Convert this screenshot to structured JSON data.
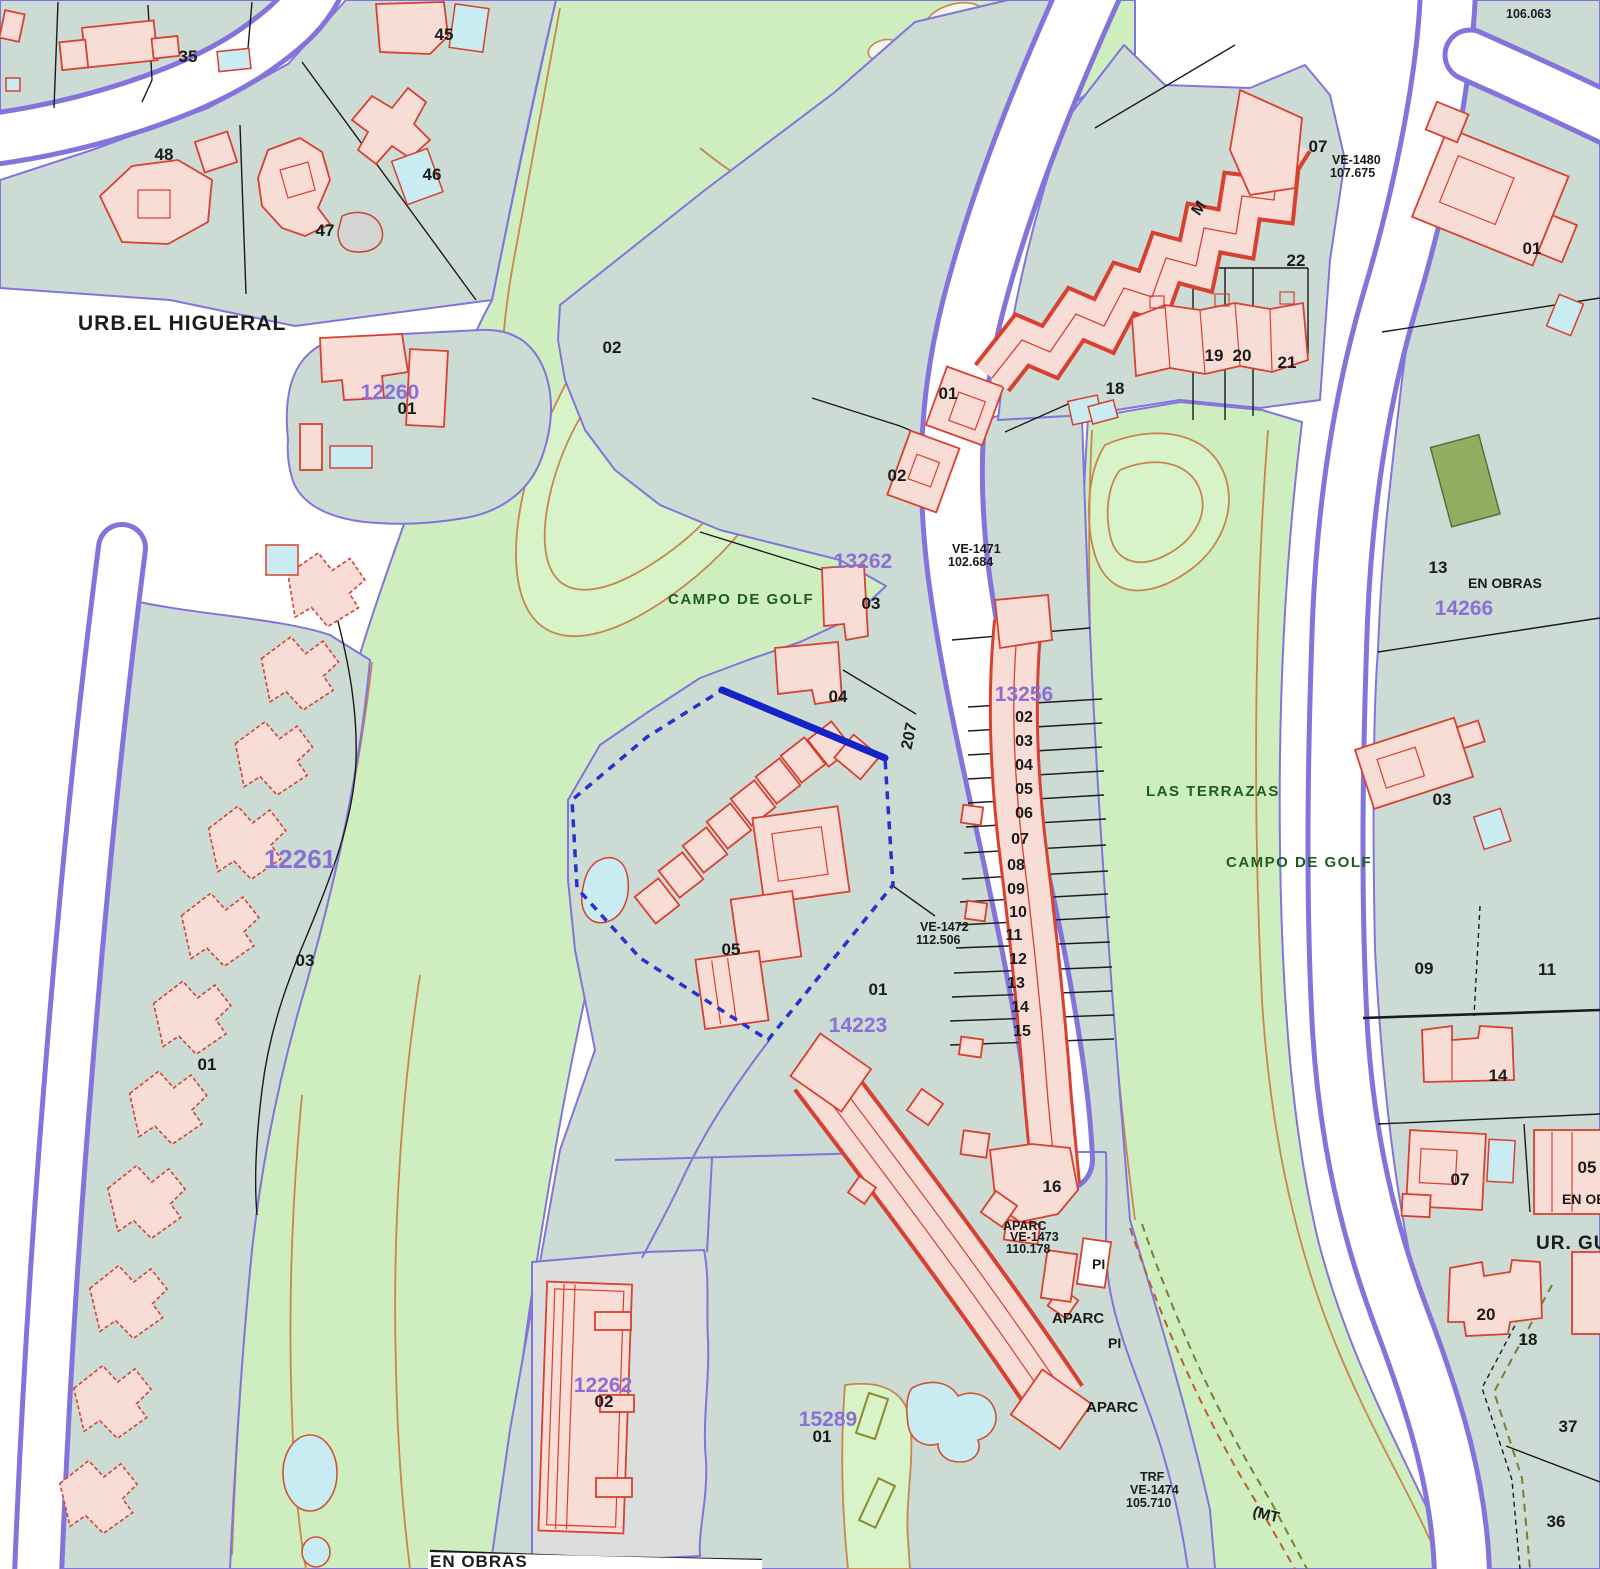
{
  "map_type": "cadastral-parcel-map",
  "colors": {
    "parcel_fill": "#ccdbd3",
    "golf_fill": "#cfeec0",
    "road_fill": "#ffffff",
    "boundary_purple": "#8374dc",
    "building_fill": "#f8ddd7",
    "building_stroke": "#d8402f",
    "pool_fill": "#c9ecf2",
    "selected_blue": "#2433cc",
    "contour_orange": "#c8854e",
    "parcel_id_purple": "#8b6fd4",
    "golf_text_green": "#1e5c20"
  },
  "labels": {
    "urb": "URB.EL HIGUERAL",
    "campo1": "CAMPO DE GOLF",
    "campo2": "CAMPO DE GOLF",
    "lasterrazas": "LAS TERRAZAS",
    "enobras1": "EN OBRAS",
    "enobras2": "EN OBRAS",
    "enobras3": "EN OBRAS",
    "urgu": "UR. GU",
    "p12260": "12260",
    "p12261": "12261",
    "p12262": "12262",
    "p13256": "13256",
    "p13262": "13262",
    "p14223": "14223",
    "p14266": "14266",
    "p15289": "15289",
    "n35": "35",
    "n45": "45",
    "n48": "48",
    "n46": "46",
    "n47": "47",
    "n01a": "01",
    "n02a": "02",
    "n01b": "01",
    "n02b": "02",
    "n03a": "03",
    "n04a": "04",
    "n05a": "05",
    "n01d": "01",
    "n18a": "18",
    "n22": "22",
    "n19": "19",
    "n20a": "20",
    "n21": "21",
    "n01e": "01",
    "n13": "13",
    "n03c": "03",
    "n09": "09",
    "n11": "11",
    "n14": "14",
    "n07b": "07",
    "n05b": "05",
    "n20b": "20",
    "n18b": "18",
    "n37": "37",
    "n36": "36",
    "n03b": "03",
    "n01c": "01",
    "n16": "16",
    "n02c": "02",
    "n01f": "01",
    "n07top": "07",
    "t02": "02",
    "t03": "03",
    "t04": "04",
    "t05": "05",
    "t06": "06",
    "t07": "07",
    "t08": "08",
    "t09": "09",
    "t10": "10",
    "t11": "11",
    "t12": "12",
    "t13": "13",
    "t14": "14",
    "t15": "15",
    "n207": "207",
    "nM": "M",
    "mt": "(MT",
    "ve1480": "VE-1480",
    "e107": "107.675",
    "e106": "106.063",
    "ve1471": "VE-1471",
    "e102": "102.684",
    "ve1472": "VE-1472",
    "e112": "112.506",
    "ve1473": "VE-1473",
    "e110": "110.178",
    "ve1474": "VE-1474",
    "e105": "105.710",
    "trf": "TRF",
    "aparc1": "APARC",
    "aparc2": "APARC",
    "aparc3": "APARC",
    "pi1": "PI",
    "pi2": "PI"
  }
}
